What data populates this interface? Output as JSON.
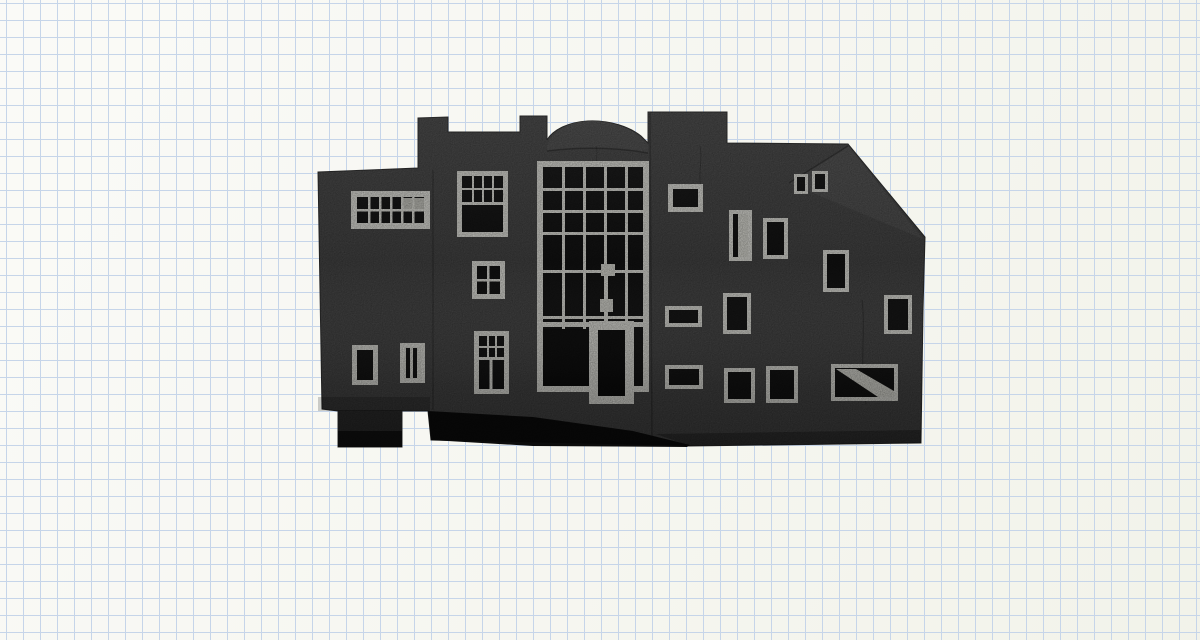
{
  "canvas": {
    "width": 1200,
    "height": 640,
    "grid_cell_px": 17
  },
  "colors": {
    "paper": "#f5f5ee",
    "grid_line": "#c6d5e9",
    "facade": "#434343",
    "facade_light": "#4b4b4b",
    "frame": "#d6d6d0",
    "frame_light": "#cfcfc8",
    "pane": "#121212",
    "shadow": "#0c0c0c"
  },
  "scene": {
    "subject": "black-and-white photograph of a handmade architectural model on graph paper",
    "features": [
      "crenellated tower",
      "barrel-vault dome roof",
      "tall gridded curtain wall with entrance door",
      "scattered punched windows with white frames",
      "sloping roofline on the right",
      "dark undercroft shadow and support foot"
    ],
    "window_count": 22
  }
}
